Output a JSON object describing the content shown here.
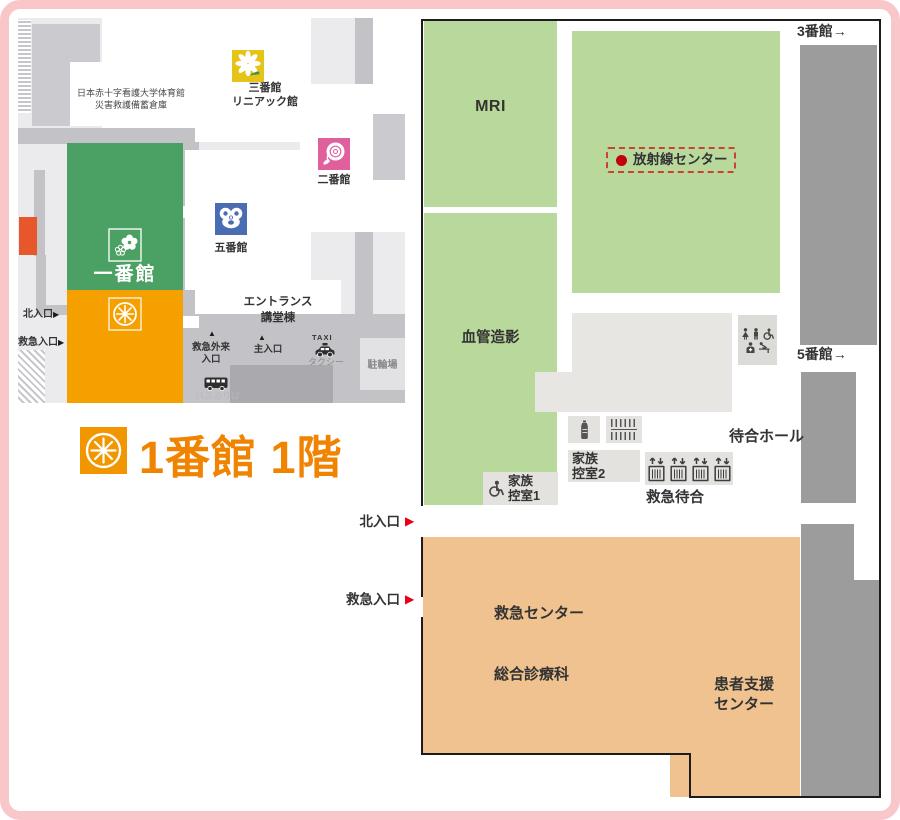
{
  "title": {
    "text": "1番館 1階"
  },
  "icons": {
    "right_arrow": "▶",
    "up_marker": "▲"
  },
  "overview": {
    "gym_line1": "日本赤十字看護大学体育館",
    "gym_line2": "災害救護備蓄倉庫",
    "bldg3_line1": "三番館",
    "bldg3_line2": "リニアック館",
    "bldg2": "二番館",
    "bldg5": "五番館",
    "bldg1": "一番館",
    "entrance_line1": "エントランス",
    "entrance_line2": "講堂棟",
    "north_entrance": "北入口",
    "emergency_entrance": "救急入口",
    "er_entrance_line1": "救急外来",
    "er_entrance_line2": "入口",
    "main_entrance": "主入口",
    "taxi_en": "TAXI",
    "taxi_jp": "タクシー",
    "bicycle": "駐輪場",
    "bus": "バスのりば"
  },
  "floor": {
    "mri": "MRI",
    "angiography": "血管造影",
    "radiation_center": "放射線センター",
    "waiting_hall": "待合ホール",
    "er_waiting": "救急待合",
    "family_room1_line1": "家族",
    "family_room1_line2": "控室1",
    "family_room2_line1": "家族",
    "family_room2_line2": "控室2",
    "er_center": "救急センター",
    "general_medicine": "総合診療科",
    "patient_support_line1": "患者支援",
    "patient_support_line2": "センター",
    "to_bldg3": "3番館→",
    "to_bldg5": "5番館→",
    "north_entrance": "北入口",
    "emergency_entrance": "救急入口"
  },
  "colors": {
    "accent_orange": "#f08300",
    "building_green": "#4ba163",
    "building_orange": "#f6a000",
    "room_green": "#b9d89b",
    "room_tan": "#f0c28f",
    "corridor_gray": "#9c9c9c",
    "frame_pink": "#f9c6ca",
    "alert_red": "#e60012"
  }
}
